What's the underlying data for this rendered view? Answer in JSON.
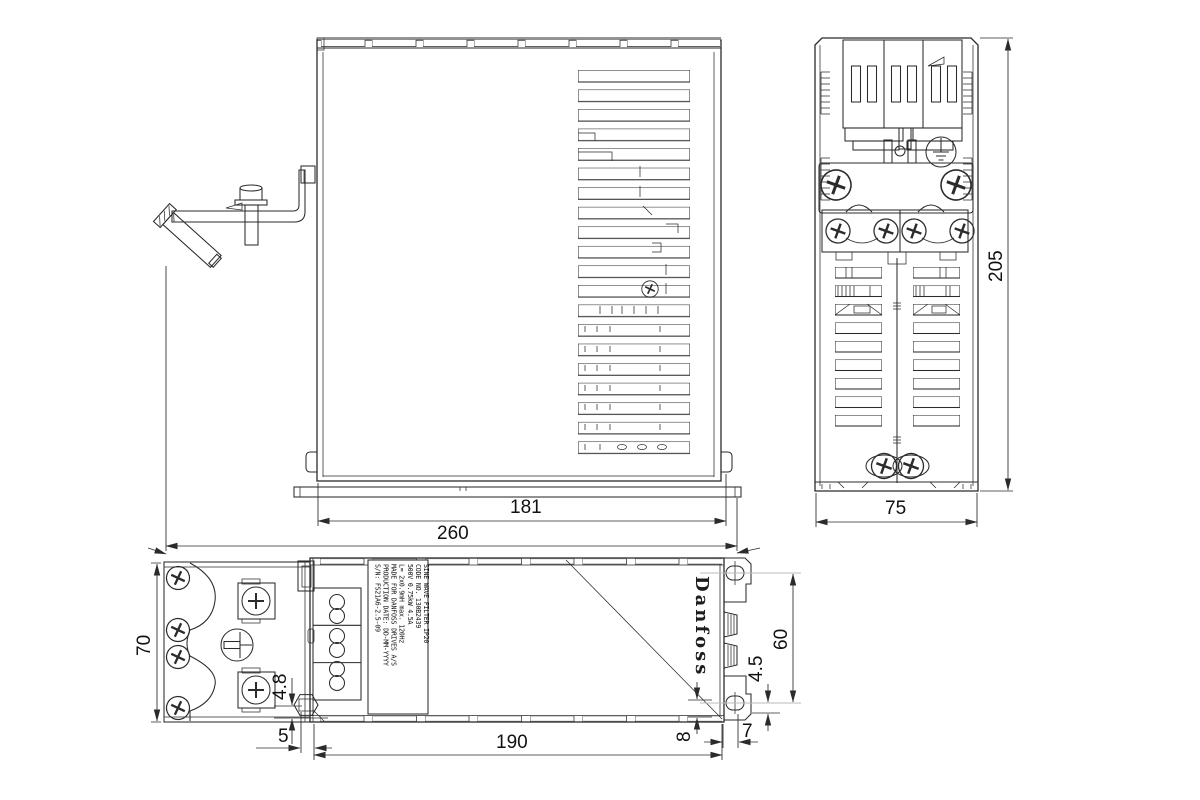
{
  "page": {
    "background": "#ffffff",
    "line_color": "#2b2b2b",
    "centerline_color": "#bbbbbb",
    "text_color": "#111111"
  },
  "brand_logo": "Danfoss",
  "views": {
    "side": {
      "title": "side-view",
      "dims": {
        "inner_width": "181",
        "overall_width": "260"
      }
    },
    "end": {
      "title": "end-view",
      "dims": {
        "height": "205",
        "width": "75"
      }
    },
    "top": {
      "title": "top-view",
      "dims": {
        "depth": "70",
        "gland_offset": "4.8",
        "gland_inset": "5",
        "body_length": "190",
        "corner_offset": "8",
        "tab_width": "7",
        "hole_to_edge": "4.5",
        "hole_spacing": "60"
      }
    }
  },
  "label": {
    "lines": [
      "SINE WAVE FILTER IP20",
      "CODE NO. 130B2439",
      "500V 0.75kW 4.5A",
      "L= 2x0.9mH   max. 120Hz",
      "MADE FOR DANFOSS DRIVES A/S",
      "PRODUCTION DATE: DD-MM-YYYY",
      "S/N: FS21A6-2.5-09"
    ]
  }
}
